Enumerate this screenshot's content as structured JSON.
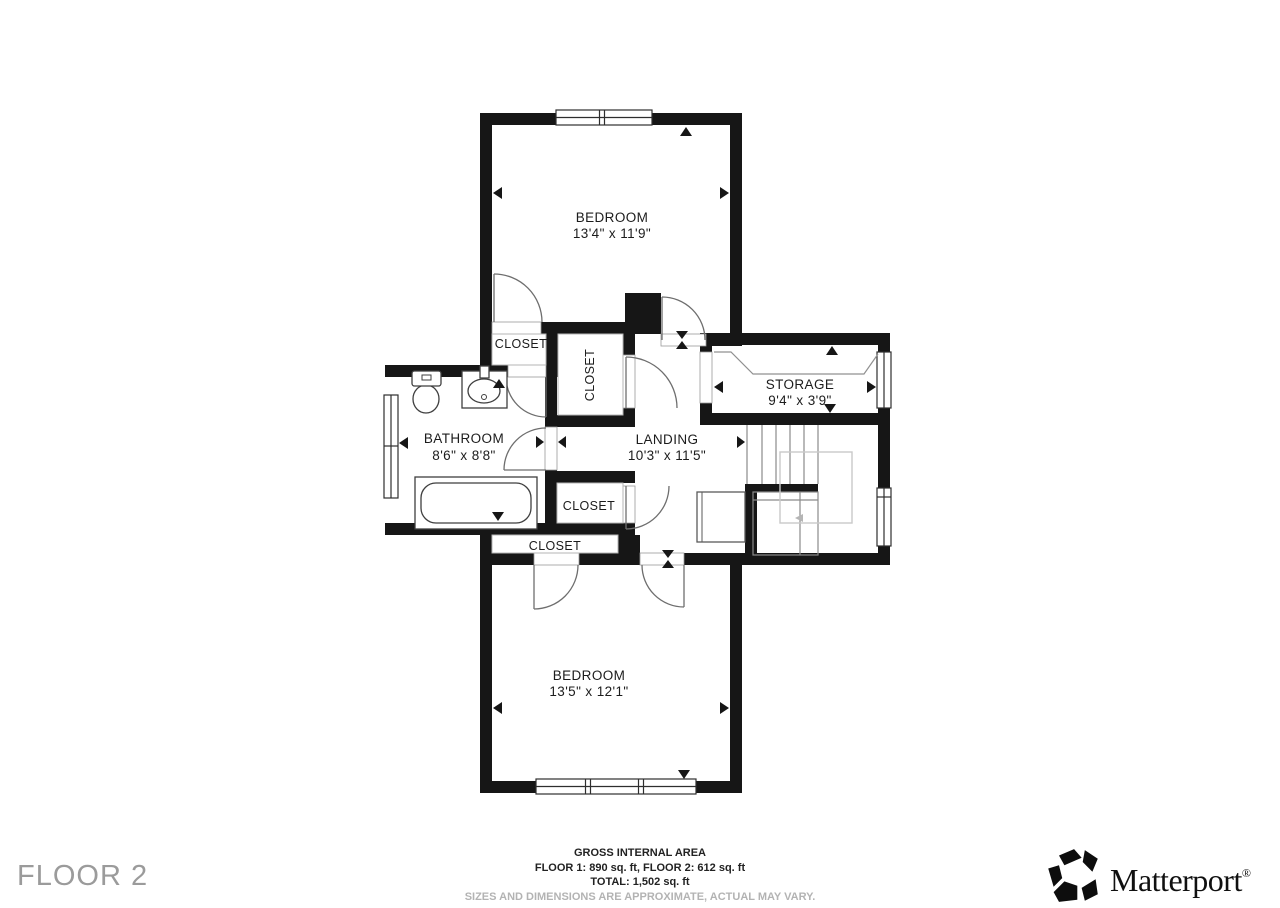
{
  "floor_label": "FLOOR 2",
  "rooms": {
    "bedroom_top": {
      "name": "BEDROOM",
      "dims": "13'4\" x 11'9\""
    },
    "closet_top": {
      "name": "CLOSET"
    },
    "closet_upper": {
      "name": "CLOSET"
    },
    "storage": {
      "name": "STORAGE",
      "dims": "9'4\" x 3'9\""
    },
    "bathroom": {
      "name": "BATHROOM",
      "dims": "8'6\" x 8'8\""
    },
    "landing": {
      "name": "LANDING",
      "dims": "10'3\" x 11'5\""
    },
    "closet_middle": {
      "name": "CLOSET"
    },
    "closet_lower": {
      "name": "CLOSET"
    },
    "bedroom_bottom": {
      "name": "BEDROOM",
      "dims": "13'5\" x 12'1\""
    }
  },
  "footer": {
    "title": "GROSS INTERNAL AREA",
    "floors": "FLOOR 1: 890 sq. ft, FLOOR 2: 612 sq. ft",
    "total": "TOTAL: 1,502 sq. ft",
    "disclaimer": "SIZES AND DIMENSIONS ARE APPROXIMATE, ACTUAL MAY VARY."
  },
  "brand": {
    "name": "Matterport",
    "registered": "®"
  },
  "colors": {
    "wall": "#161616",
    "label": "#1c1c1c",
    "muted": "#9b9b9b",
    "disclaimer": "#b3b3b3"
  }
}
